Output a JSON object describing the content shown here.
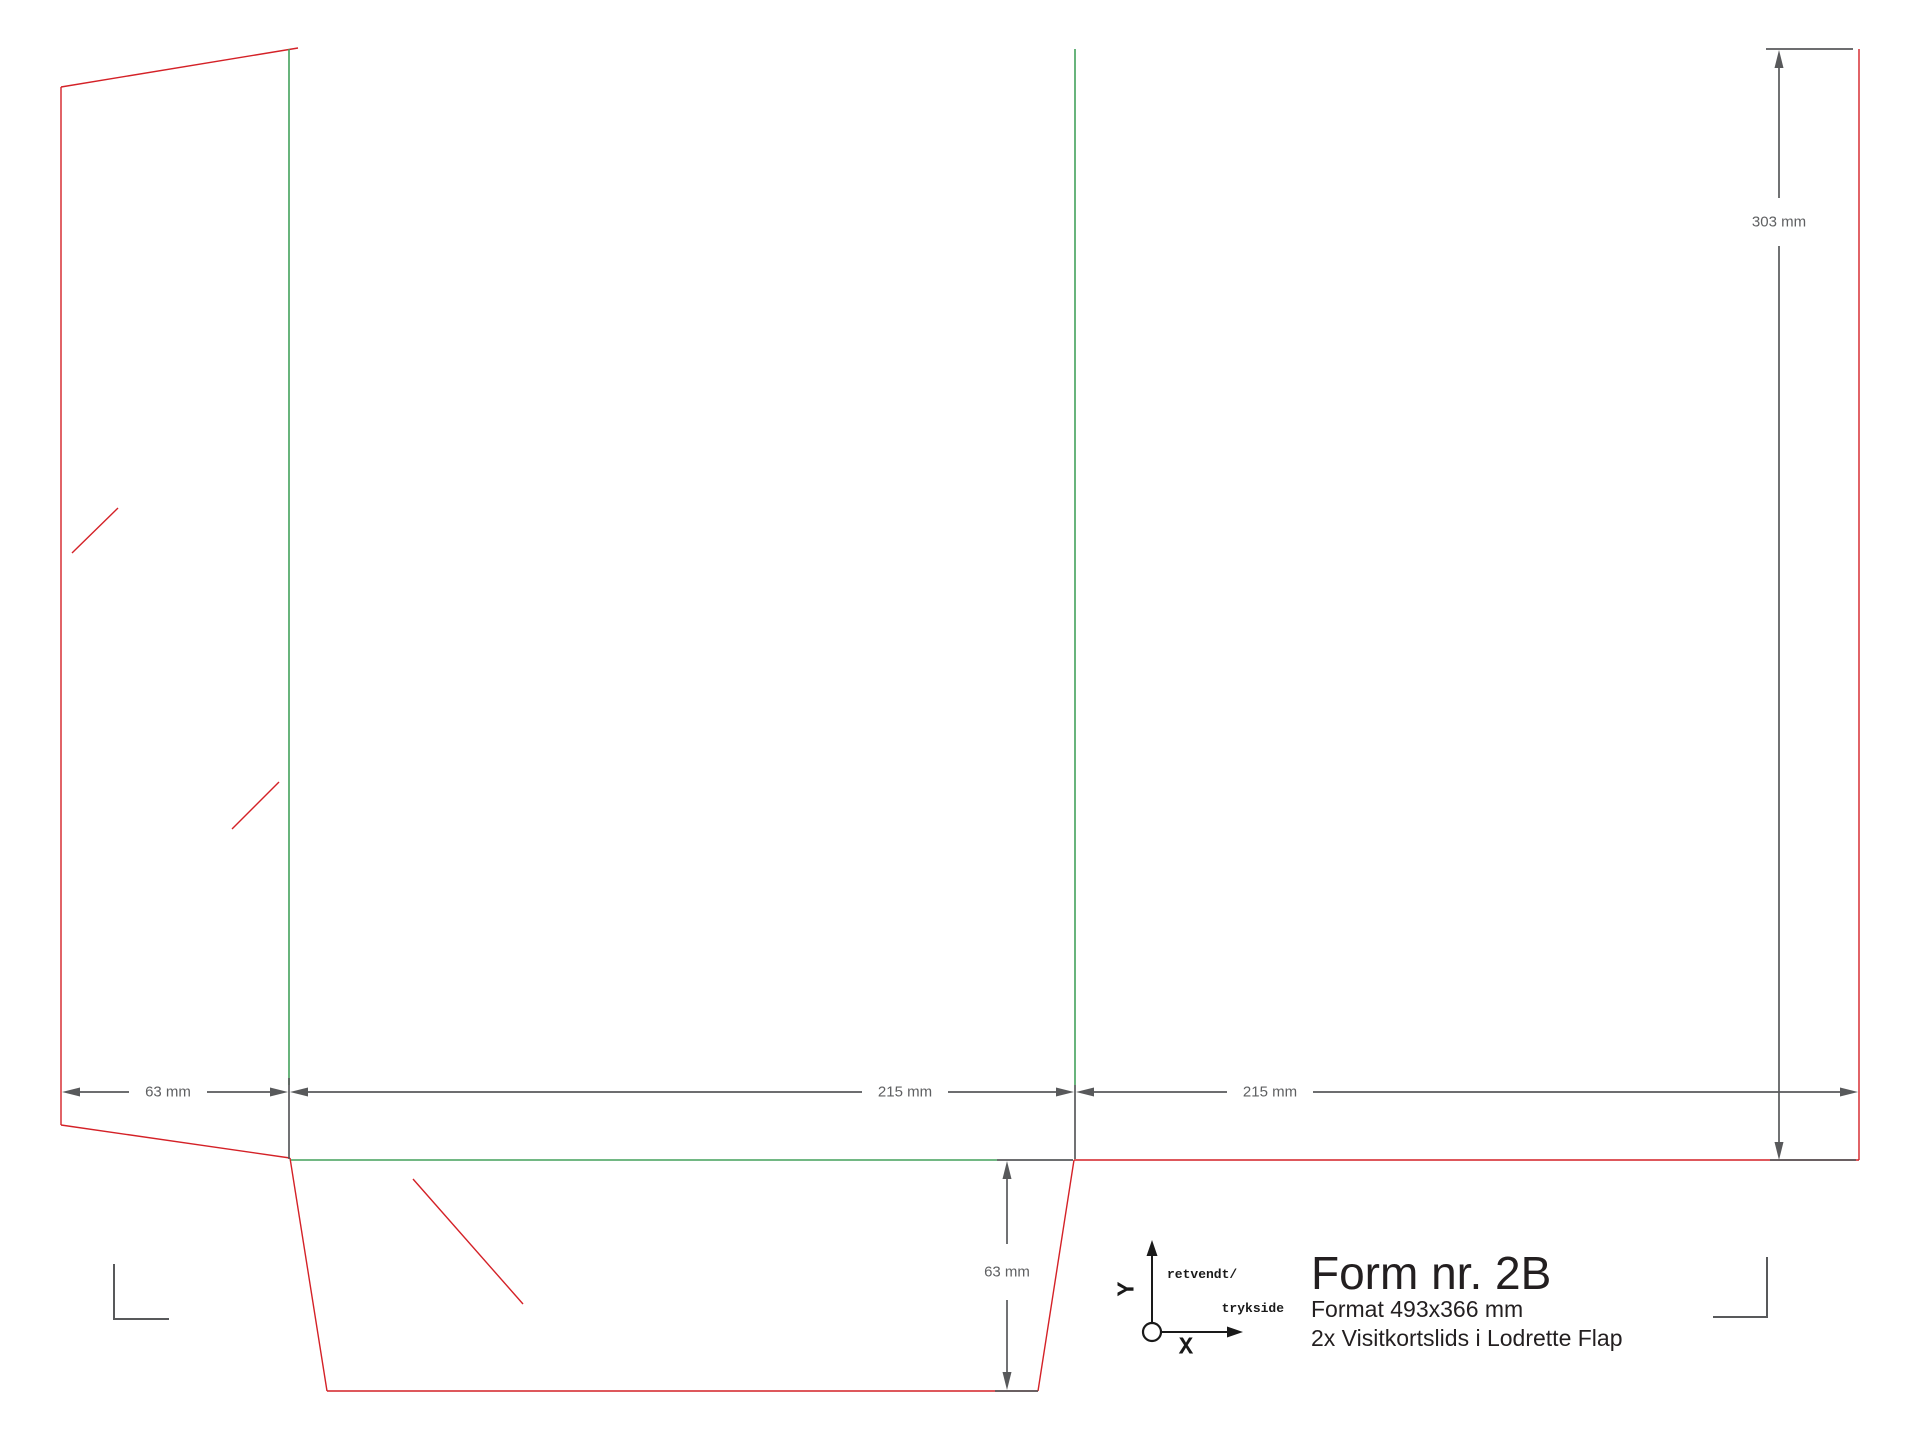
{
  "drawing": {
    "type": "die-cut folder template",
    "cut_color": "#d42127",
    "fold_color": "#43a15c",
    "dimension_color": "#58595b"
  },
  "dims": {
    "left_flap_width": "63 mm",
    "panel1_width": "215 mm",
    "panel2_width": "215 mm",
    "panel_height": "303 mm",
    "bottom_flap_height": "63 mm"
  },
  "axis": {
    "y": "Y",
    "x": "X",
    "note_line1": "retvendt/",
    "note_line2": "trykside"
  },
  "title_block": {
    "title": "Form nr. 2B",
    "format": "Format 493x366 mm",
    "description": "2x Visitkortslids i Lodrette Flap"
  }
}
